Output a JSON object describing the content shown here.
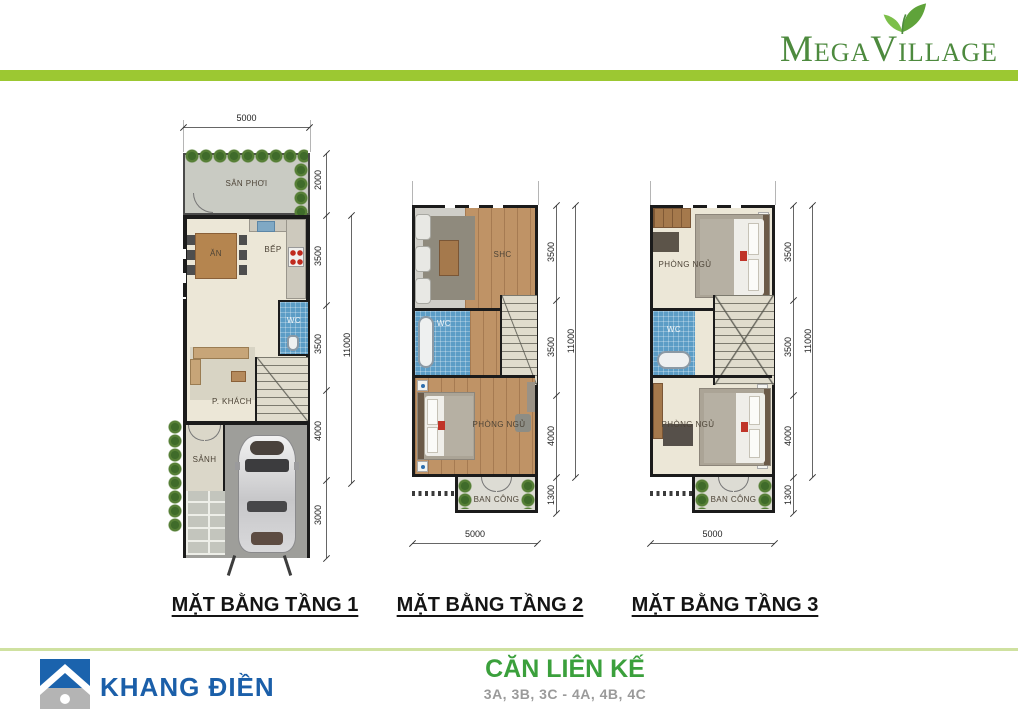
{
  "header": {
    "brand_mega": "MEGA",
    "brand_village": "VILLAGE"
  },
  "plans": [
    {
      "title": "MẶT BẰNG TẦNG 1",
      "rooms": {
        "san_phoi": "SÂN PHƠI",
        "an": "ĂN",
        "bep": "BẾP",
        "wc": "WC",
        "p_khach": "P. KHÁCH",
        "sanh": "SẢNH"
      },
      "dims": {
        "width_top": "5000",
        "seg1": "2000",
        "seg2": "3500",
        "seg3": "3500",
        "seg4": "4000",
        "seg5": "3000",
        "total": "11000"
      }
    },
    {
      "title": "MẶT BẰNG TẦNG 2",
      "rooms": {
        "shc": "SHC",
        "wc": "WC",
        "phong_ngu": "PHÒNG NGỦ",
        "ban_cong": "BAN CÔNG"
      },
      "dims": {
        "seg1": "3500",
        "seg2": "3500",
        "seg3": "4000",
        "seg4": "1300",
        "total": "11000",
        "width_bottom": "5000"
      }
    },
    {
      "title": "MẶT BẰNG TẦNG 3",
      "rooms": {
        "phong_ngu_1": "PHÒNG NGỦ",
        "wc": "WC",
        "phong_ngu_2": "PHÒNG NGỦ",
        "ban_cong": "BAN CÔNG"
      },
      "dims": {
        "seg1": "3500",
        "seg2": "3500",
        "seg3": "4000",
        "seg4": "1300",
        "total": "11000",
        "width_bottom": "5000"
      }
    }
  ],
  "footer": {
    "company": "KHANG ĐIỀN",
    "product_title": "CĂN LIÊN KẾ",
    "product_units": "3A, 3B, 3C - 4A, 4B, 4C"
  },
  "colors": {
    "brand_green": "#4d8a3e",
    "band_green": "#9cc832",
    "khang_dien_blue": "#1b5fa9",
    "product_title_green": "#3ba03c"
  }
}
